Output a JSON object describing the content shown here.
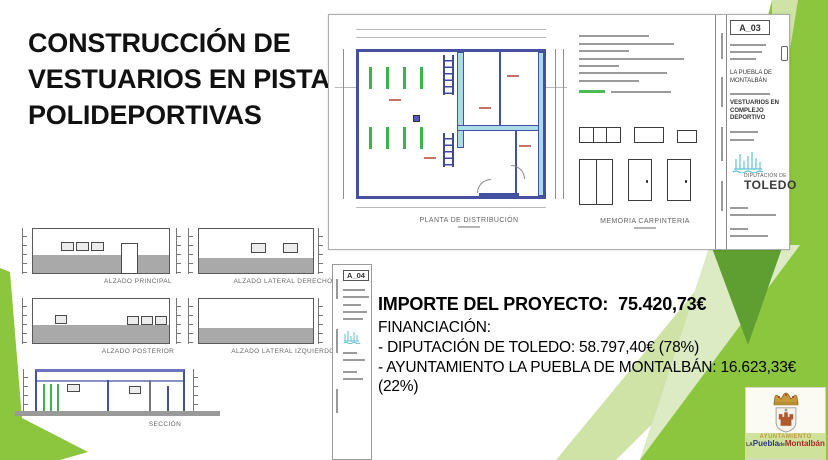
{
  "slide": {
    "title": "CONSTRUCCIÓN DE VESTUARIOS EN PISTAS POLIDEPORTIVAS"
  },
  "plan_sheet": {
    "sheet_code": "A_03",
    "plan_label": "PLANTA DE DISTRIBUCIÓN",
    "carpentry_label": "MEMORIA CARPINTERIA",
    "titleblock": {
      "municipality": "LA PUEBLA DE MONTALBÁN",
      "project": "VESTUARIOS EN COMPLEJO DEPORTIVO",
      "org_line1": "DIPUTACIÓN DE",
      "org_line2": "TOLEDO"
    }
  },
  "drawings": {
    "elevations": [
      {
        "label": "ALZADO PRINCIPAL"
      },
      {
        "label": "ALZADO LATERAL DERECHO"
      },
      {
        "label": "ALZADO POSTERIOR"
      },
      {
        "label": "ALZADO LATERAL IZQUIERDO"
      }
    ],
    "section_label": "SECCIÓN"
  },
  "a04_sheet": {
    "sheet_code": "A_04"
  },
  "finance": {
    "project_cost_label": "IMPORTE DEL PROYECTO:",
    "project_cost_value": "75.420,73€",
    "funding_label": "FINANCIACIÓN:",
    "funding_lines": [
      "- DIPUTACIÓN DE TOLEDO: 58.797,40€ (78%)",
      "- AYUNTAMIENTO LA PUEBLA DE MONTALBÁN: 16.623,33€ (22%)"
    ]
  },
  "town_logo": {
    "line1": "AYUNTAMIENTO",
    "la": "LA",
    "puebla": "Puebla",
    "de": "de",
    "montalban": "Montalbán"
  },
  "colors": {
    "green_medium": "#8cc63f",
    "green_dark": "#5f9e31",
    "green_light": "#d9e8bc",
    "teal_logo": "#5ec1d4",
    "plan_navy": "#4450a0",
    "plan_cyan": "#aadbe8",
    "fixture_green": "#3bb44a",
    "title_text": "#111111"
  }
}
